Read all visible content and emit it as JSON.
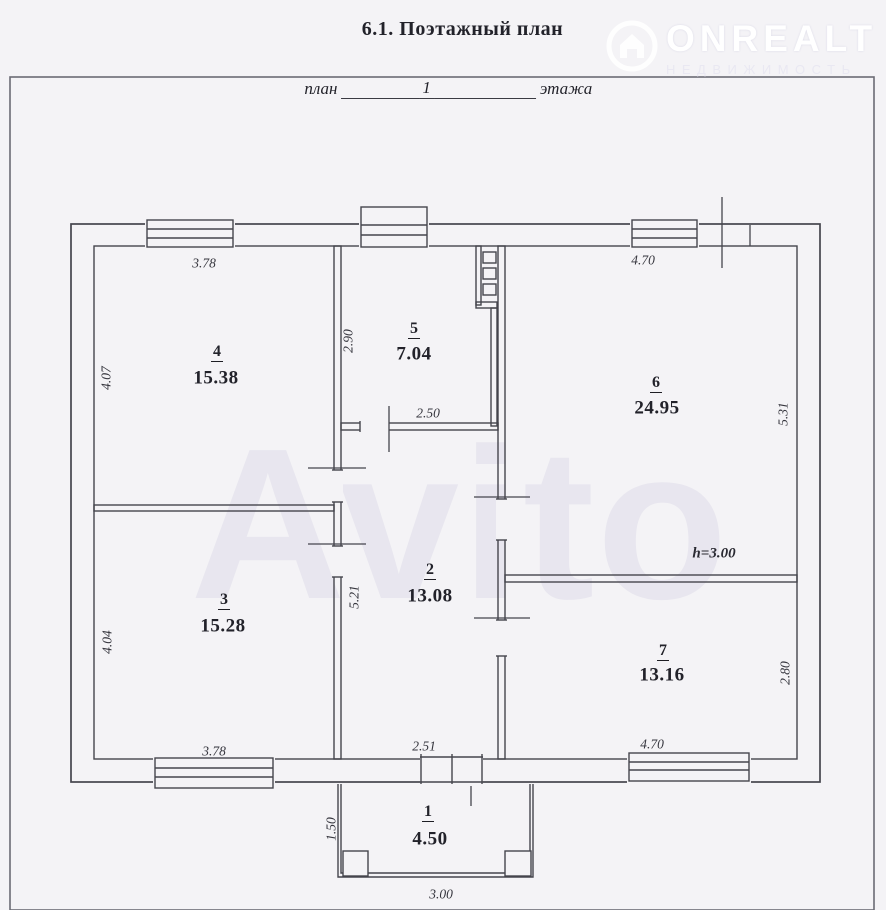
{
  "document": {
    "title": "6.1. Поэтажный план",
    "plan_line": {
      "prefix": "план",
      "floor_number": "1",
      "suffix": "этажа"
    }
  },
  "watermark": {
    "brand": "ONREALT",
    "brand_subtitle": "НЕДВИЖИМОСТЬ",
    "photo_overlay": "Avito"
  },
  "plan": {
    "height_note": "h=3.00",
    "rooms": [
      {
        "number": "1",
        "area": "4.50",
        "dims": {
          "left": "1.50",
          "bottom": "3.00"
        }
      },
      {
        "number": "2",
        "area": "13.08",
        "dims": {
          "left": "5.21",
          "bottom": "2.51"
        }
      },
      {
        "number": "3",
        "area": "15.28",
        "dims": {
          "left": "4.04",
          "bottom": "3.78"
        }
      },
      {
        "number": "4",
        "area": "15.38",
        "dims": {
          "top": "3.78",
          "left": "4.07"
        }
      },
      {
        "number": "5",
        "area": "7.04",
        "dims": {
          "left": "2.90",
          "bottom": "2.50"
        }
      },
      {
        "number": "6",
        "area": "24.95",
        "dims": {
          "top": "4.70",
          "right": "5.31"
        }
      },
      {
        "number": "7",
        "area": "13.16",
        "dims": {
          "right": "2.80",
          "bottom": "4.70"
        }
      }
    ]
  },
  "colors": {
    "ink": "#45454d",
    "paper": "#f4f3f6",
    "watermark": "#e3e2ec"
  }
}
